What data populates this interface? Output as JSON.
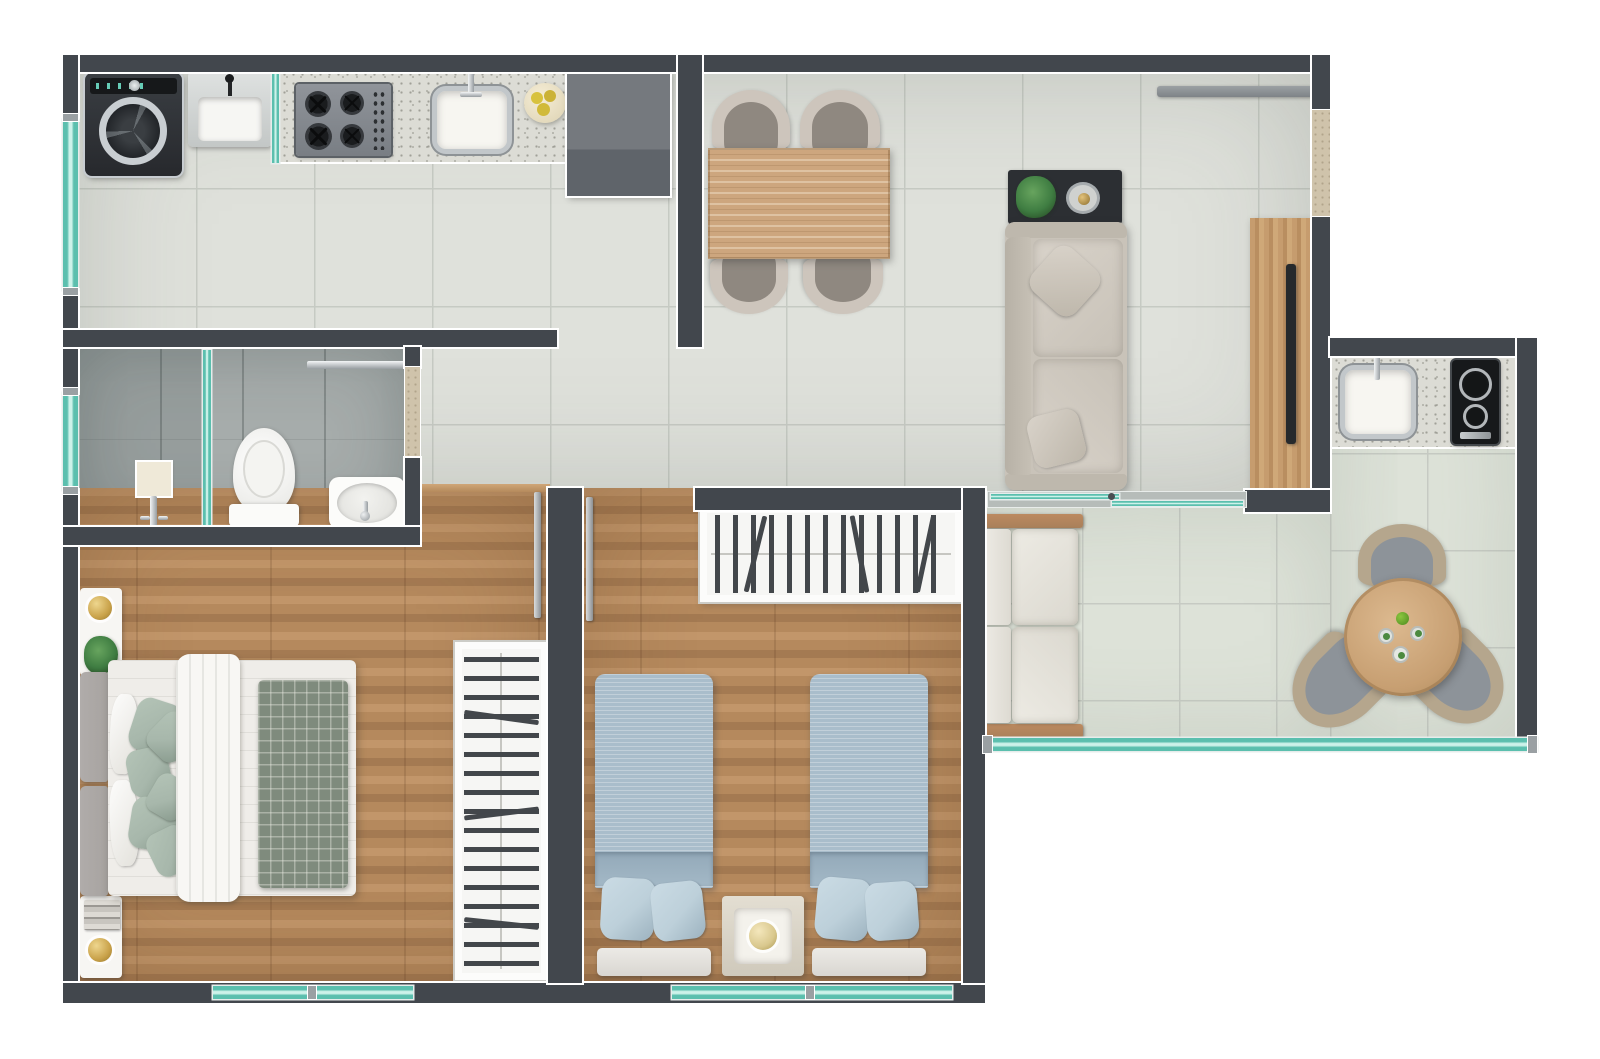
{
  "plan": {
    "type": "apartment-floor-plan-top-view-render",
    "canvas": {
      "width": 1600,
      "height": 1059
    },
    "palette": {
      "page_bg": "#ffffff",
      "wall": "#42474d",
      "wall_cap": "#9aa0a3",
      "wall_beige": "#cfc3ab",
      "tile": "#dfe1db",
      "tile_grout": "#c6cac3",
      "balcony_tile": "#dde2d8",
      "bath_floor": "#a6acab",
      "wood_floor": "#b5895d",
      "wood_dark": "#a47a52",
      "wood_light": "#c2966a",
      "wood_furniture": "#cda67e",
      "glass": "#5bbfae",
      "glass_light": "#cdf2ea",
      "counter": "#dcdcd5",
      "cabinet": "#6e7378",
      "appliance": "#2e3134",
      "chrome": "#c9cdd0",
      "white_goods": "#f7f6f3",
      "sofa": "#c9c3b9",
      "sofa_light": "#d9d3ca",
      "pillow_green": "#a7b7ab",
      "quilt_gray": "#7f8b7d",
      "bed_blue": "#a9bdcb",
      "pillow_blue": "#bdd0da",
      "headboard": "#a7a3a0",
      "gold": "#c9a24a",
      "plant": "#3f7d42",
      "wicker": "#b5a68d",
      "seat_gray": "#8d9399",
      "chair_ring": "#cdc5bc",
      "chair_seat": "#8f8880",
      "hanger": "#43474b"
    },
    "rooms": [
      {
        "id": "kitchen",
        "name": "Kitchen / Laundry"
      },
      {
        "id": "living",
        "name": "Living / Dining Room"
      },
      {
        "id": "bathroom",
        "name": "Bathroom"
      },
      {
        "id": "bedroom1",
        "name": "Bedroom 1 (double bed)"
      },
      {
        "id": "bedroom2",
        "name": "Bedroom 2 (twin beds)"
      },
      {
        "id": "hallway",
        "name": "Hallway"
      },
      {
        "id": "balcony",
        "name": "Balcony / Gourmet Terrace"
      }
    ],
    "furniture": {
      "kitchen": [
        "washing-machine",
        "laundry-tub",
        "glass-partition",
        "countertop",
        "cooktop-4-burners",
        "kitchen-sink",
        "fruit-bowl",
        "tall-cabinet"
      ],
      "living": [
        "dining-table",
        "dining-chair-x4",
        "console-table",
        "potted-plant",
        "serving-tray",
        "sofa-2-seat",
        "throw-pillow-x2",
        "tv-panel",
        "tv",
        "curtain-rail"
      ],
      "bathroom": [
        "shower-mixer",
        "shower-column",
        "glass-screen",
        "toilet",
        "washbasin",
        "towel-rail"
      ],
      "bedroom1": [
        "double-bed",
        "headboard",
        "white-pillow-x2",
        "green-pillow-x6",
        "duvet",
        "quilt",
        "nightstand-x2",
        "table-lamp-x2",
        "plant",
        "books",
        "open-wardrobe"
      ],
      "bedroom2": [
        "open-wardrobe",
        "single-bed-x2",
        "blue-pillow-x4",
        "headboard-x2",
        "nightstand",
        "table-lamp"
      ],
      "balcony": [
        "sliding-glass-door",
        "outdoor-sofa-2-seat",
        "balcony-sink",
        "cooktop-2-burners",
        "round-table",
        "wicker-chair-x3",
        "drink-glass-x3",
        "glass-railing"
      ]
    },
    "counts": {
      "dining_chairs": 4,
      "stove_burners": 4,
      "balcony_burners": 2,
      "balcony_chairs": 3,
      "single_beds": 2,
      "bedrooms": 2,
      "bathrooms": 1
    }
  }
}
